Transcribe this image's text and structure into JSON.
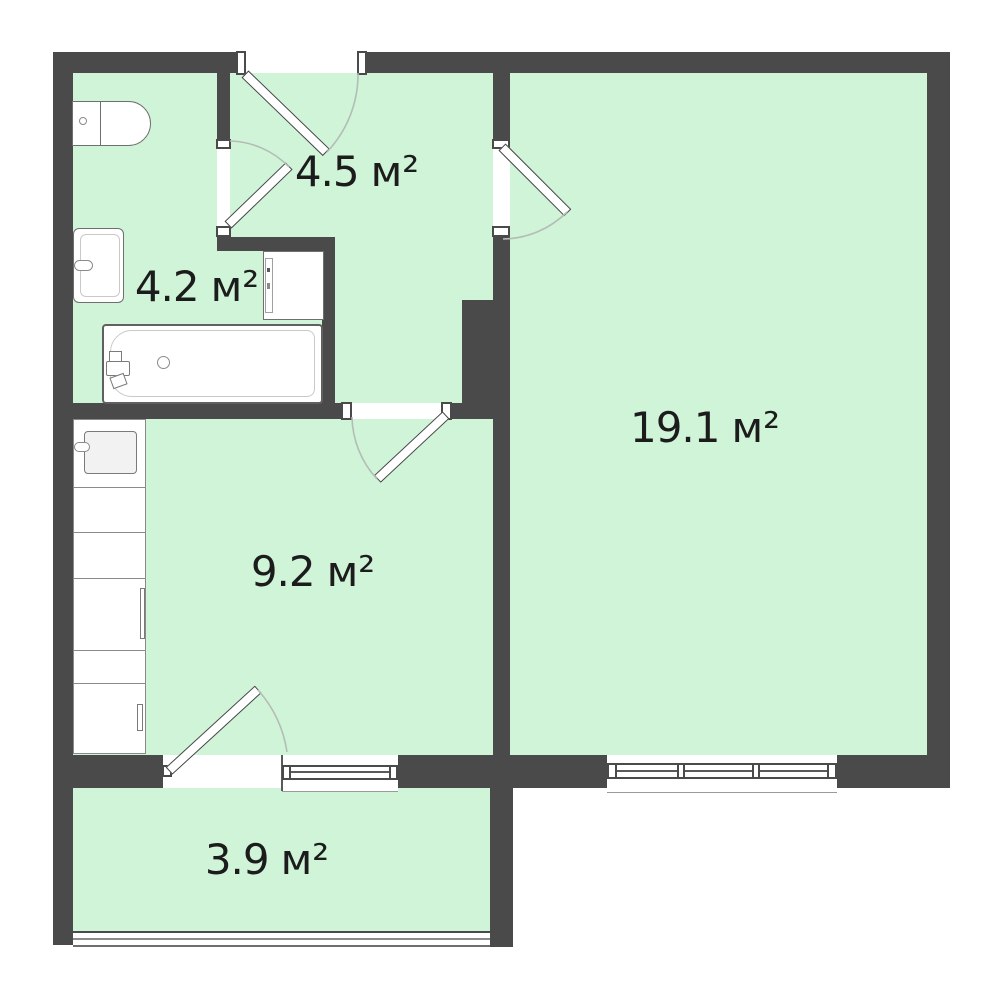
{
  "colors": {
    "wall": "#4a4a4a",
    "room_fill": "#cff4d8",
    "door_window": "#ffffff",
    "fixture_outline": "#8a8a8a",
    "swing_arc": "#b4bcb6",
    "label_text": "#1c1c1c",
    "background": "#ffffff"
  },
  "rooms": {
    "hallway": {
      "area": "4.5",
      "unit": "м²"
    },
    "bathroom": {
      "area": "4.2",
      "unit": "м²"
    },
    "living_room": {
      "area": "19.1",
      "unit": "м²"
    },
    "kitchen": {
      "area": "9.2",
      "unit": "м²"
    },
    "balcony": {
      "area": "3.9",
      "unit": "м²"
    }
  },
  "fixtures": {
    "bathroom": [
      "toilet-icon",
      "sink-icon",
      "washing-machine-icon",
      "bathtub-icon"
    ],
    "kitchen": [
      "kitchen-sink-icon",
      "counter-icon",
      "oven-icon",
      "cabinet-icon"
    ]
  },
  "openings": {
    "doors": [
      "entrance-door",
      "bathroom-door",
      "living-room-door",
      "kitchen-door",
      "balcony-door"
    ],
    "windows": [
      "kitchen-window",
      "living-room-window",
      "balcony-glazing"
    ]
  }
}
